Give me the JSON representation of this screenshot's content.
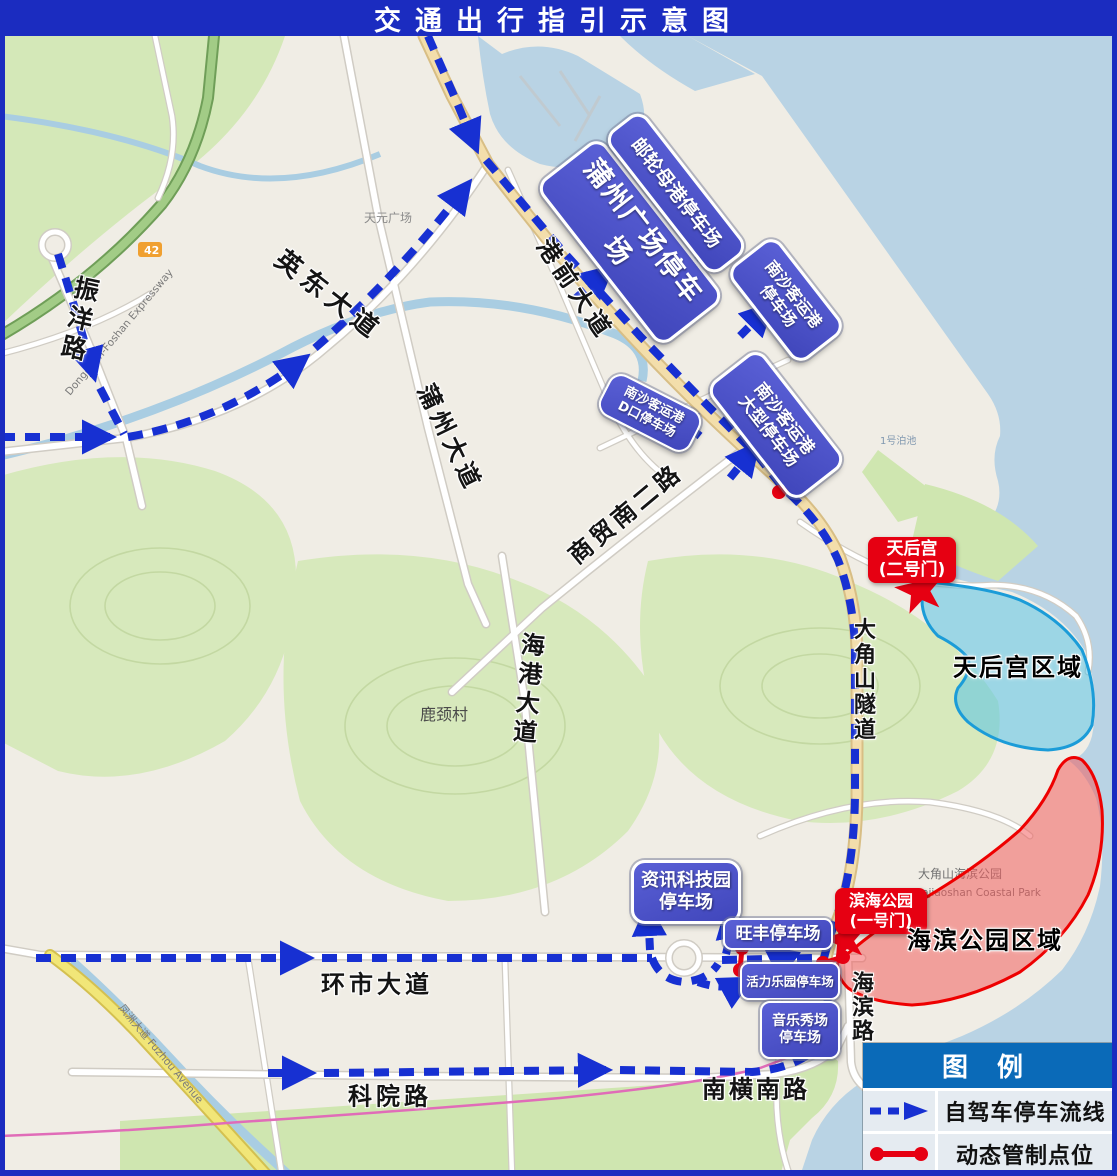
{
  "title": "交通出行指引示意图",
  "legend": {
    "title": "图 例",
    "items": [
      {
        "symbol": "blue-dashed-arrow",
        "label": "自驾车停车流线"
      },
      {
        "symbol": "red-control-segment",
        "label": "动态管制点位"
      }
    ]
  },
  "road_labels": {
    "zhenyang": "振洋路",
    "yingdong": "英东大道",
    "puzhou_ave": "蒲州大道",
    "gangqian": "港前大道",
    "shangmao": "商贸南二路",
    "haigang": "海港大道",
    "tunnel": "大角山隧道",
    "huanshi": "环市大道",
    "keyuan": "科院路",
    "nanheng": "南横南路",
    "haibin_rd": "海滨路"
  },
  "parking": {
    "puzhou_plaza": "蒲州广场停车场",
    "cruise_home_port": "邮轮母港停车场",
    "nansha_port": "南沙客运港\n停车场",
    "nansha_port_large": "南沙客运港\n大型停车场",
    "nansha_port_d": "南沙客运港\nD口停车场",
    "info_tech_park": "资讯科技园\n停车场",
    "wangfeng": "旺丰停车场",
    "vitality_park": "活力乐园停车场",
    "music_show": "音乐秀场\n停车场"
  },
  "gates": {
    "tianhou": "天后宫\n(二号门)",
    "binhai": "滨海公园\n(一号门)"
  },
  "regions": {
    "tianhou": "天后宫区域",
    "binhai": "海滨公园区域"
  },
  "map_texts": {
    "gangwan_street": "港湾街道",
    "gangwan_en": "Gangwan",
    "tianyuan_plaza": "天元广场",
    "lujing_village": "鹿颈村",
    "coastal_park_cn": "大角山海滨公园",
    "coastal_park_en": "Dajiaoshan Coastal Park",
    "expressway": "Dongguan-Foshan Expressway",
    "fuzhou_ave": "凤洲大道 Fuzhou Avenue",
    "berth1": "1号泊池",
    "road_badge": "42"
  },
  "colors": {
    "title_bg": "#1b2cc0",
    "route_blue": "#1730d2",
    "control_red": "#e60012",
    "parking_bg": "#474dc2",
    "legend_header_bg": "#0a6ab8",
    "tianhou_region_fill": "#58c3e6",
    "binhai_region_fill": "#f25f5f"
  }
}
